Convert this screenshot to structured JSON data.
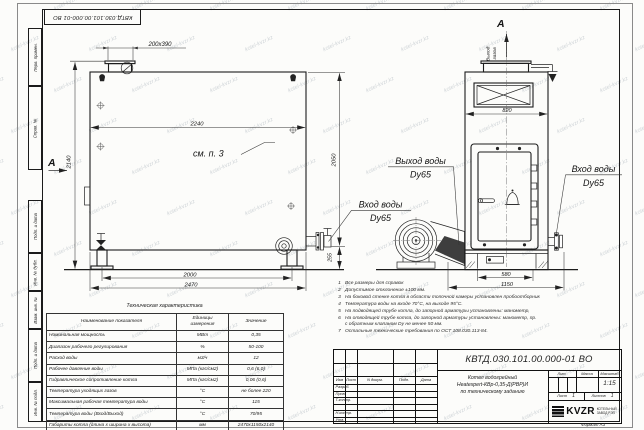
{
  "doc": {
    "number": "КВТД.030.101.00.000-01 ВО",
    "format": "Формат  А3"
  },
  "watermark": "kotel-kvzr.kz",
  "margin": [
    "Перв. примен.",
    "Справ. №",
    "Подп. и дата",
    "Инв. № дубл.",
    "Взам. инв. №",
    "Подп. и дата",
    "Инв. № подл."
  ],
  "views": {
    "section": "А",
    "gas1": "Выход",
    "gas2": "газов",
    "see": "см. п. 3",
    "d200": "200х390",
    "d2240": "2240",
    "d2140": "2140",
    "d2050": "2050",
    "d255": "255",
    "d2000": "2000",
    "d2470": "2470",
    "d820": "820",
    "d580": "580",
    "d1150": "1150",
    "out1": "Выход воды",
    "out2": "Dy65",
    "inL1": "Вход воды",
    "inL2": "Dy65",
    "inR1": "Вход воды",
    "inR2": "Dy65"
  },
  "notes": [
    {
      "num": "1",
      "text": "Все размеры для справок"
    },
    {
      "num": "2",
      "text": "Допустимое отклонение ±100 мм."
    },
    {
      "num": "3",
      "text": "На боковой стенке котла в области топочной камеры установлен пробоотборник"
    },
    {
      "num": "4",
      "text": "Температура воды на входе 70°С, на выходе 95°С."
    },
    {
      "num": "5",
      "text": "На подводящей трубе котла, до запорной арматуры установлены: манометр,"
    },
    {
      "num": "6",
      "text": "На отводящей трубе котла, до запорной арматуры установлены: манометр, пр."
    },
    {
      "num": "",
      "text": "с обратным клапаном Dу не менее 50 мм."
    },
    {
      "num": "7",
      "text": "Остальные технические требования по ОСТ 108.030.113-84."
    }
  ],
  "table": {
    "title": "Техническая характеристика",
    "h": [
      "Наименование показателя",
      "Единицы\nизмерения",
      "Значение"
    ],
    "rows": [
      {
        "n": "Номинальная мощность",
        "u": "МВт",
        "v": "0,35"
      },
      {
        "n": "Диапазон рабочего регулирования",
        "u": "%",
        "v": "50-100"
      },
      {
        "n": "Расход воды",
        "u": "м3/ч",
        "v": "12"
      },
      {
        "n": "Рабочее давление воды",
        "u": "МПа (кгс/см2)",
        "v": "0,6 (6,0)"
      },
      {
        "n": "Гидравлическое сопротивление котла",
        "u": "МПа (кгс/см2)",
        "v": "0,06 (0,6)"
      },
      {
        "n": "Температура уходящих газов",
        "u": "°С",
        "v": "не более 220"
      },
      {
        "n": "Максимальная рабочая температура воды",
        "u": "°С",
        "v": "115"
      },
      {
        "n": "Температура воды (Вход/Выход)",
        "u": "°С",
        "v": "70/95"
      },
      {
        "n": "Габариты котла (длина х ширина х высота)",
        "u": "мм",
        "v": "2470х1150х2140"
      }
    ]
  },
  "tb": {
    "cols": {
      "izm": "Изм",
      "list": "Лист",
      "ndok": "N докум.",
      "podp": "Подп.",
      "data": "Дата"
    },
    "rows": {
      "razrab": "Разраб.",
      "prov": "Пров.",
      "tkontr": "Т.контр.",
      "nkontr": "Н.контр.",
      "utv": "Утв."
    },
    "name1": "Котел водогрейный",
    "name2": "Heatexpert-КВр-0,35-Д(РВР)И",
    "name3": "по техническому заданию",
    "lit": "Лит.",
    "massa": "Масса",
    "masshtab": "Масштаб",
    "scale": "1:15",
    "sheet_label": "Лист",
    "sheet": "1",
    "sheets_label": "Листов",
    "sheets": "1",
    "logo": "KVZR",
    "logo_sub1": "КОТЕЛЬНЫЙ",
    "logo_sub2": "ЗАВОД РЭП"
  }
}
